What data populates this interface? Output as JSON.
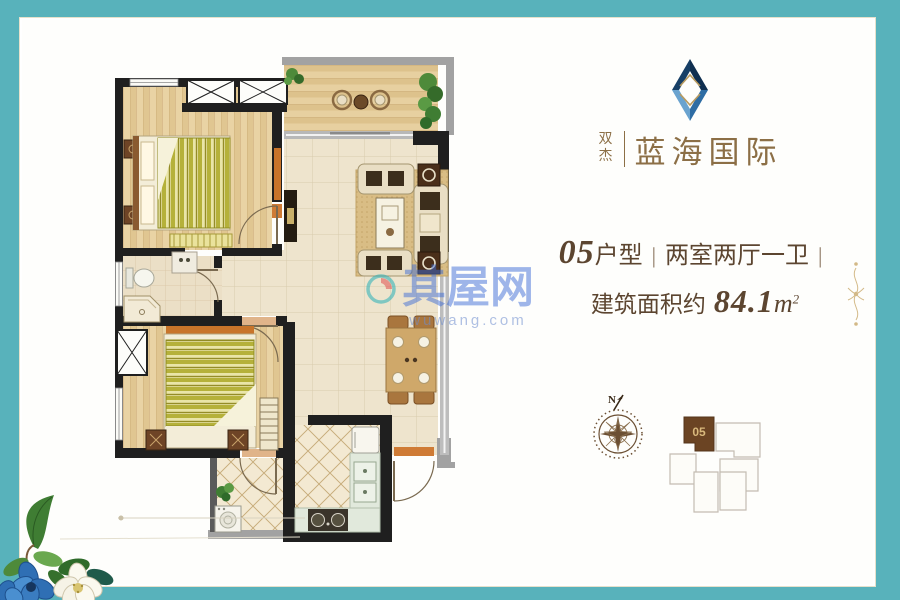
{
  "brand": {
    "prefix": "双杰",
    "name": "蓝海国际"
  },
  "unit": {
    "number": "05",
    "type_suffix": "户型",
    "separator": "|",
    "rooms": "两室两厅一卫",
    "trailing_separator": "|"
  },
  "area": {
    "label": "建筑面积约",
    "value": "84.1",
    "unit": "m",
    "superscript": "2"
  },
  "watermark": {
    "text": "其屋网",
    "domain": "wuwang.com"
  },
  "compass": {
    "north_label": "N"
  },
  "site_plan": {
    "highlight_label": "05"
  },
  "colors": {
    "border_teal": "#58b2bb",
    "brand_gold": "#8c6f46",
    "text_brown": "#5c4530",
    "watermark_blue": "#3e6cd8",
    "logo_navy": "#173f66",
    "logo_blue": "#2e6da4",
    "logo_light": "#6aa3cf",
    "wall_black": "#1f1f1f",
    "accent_orange": "#c8742a",
    "site_highlight_brown": "#6b4423",
    "site_unit_gold": "#d9b97c"
  }
}
